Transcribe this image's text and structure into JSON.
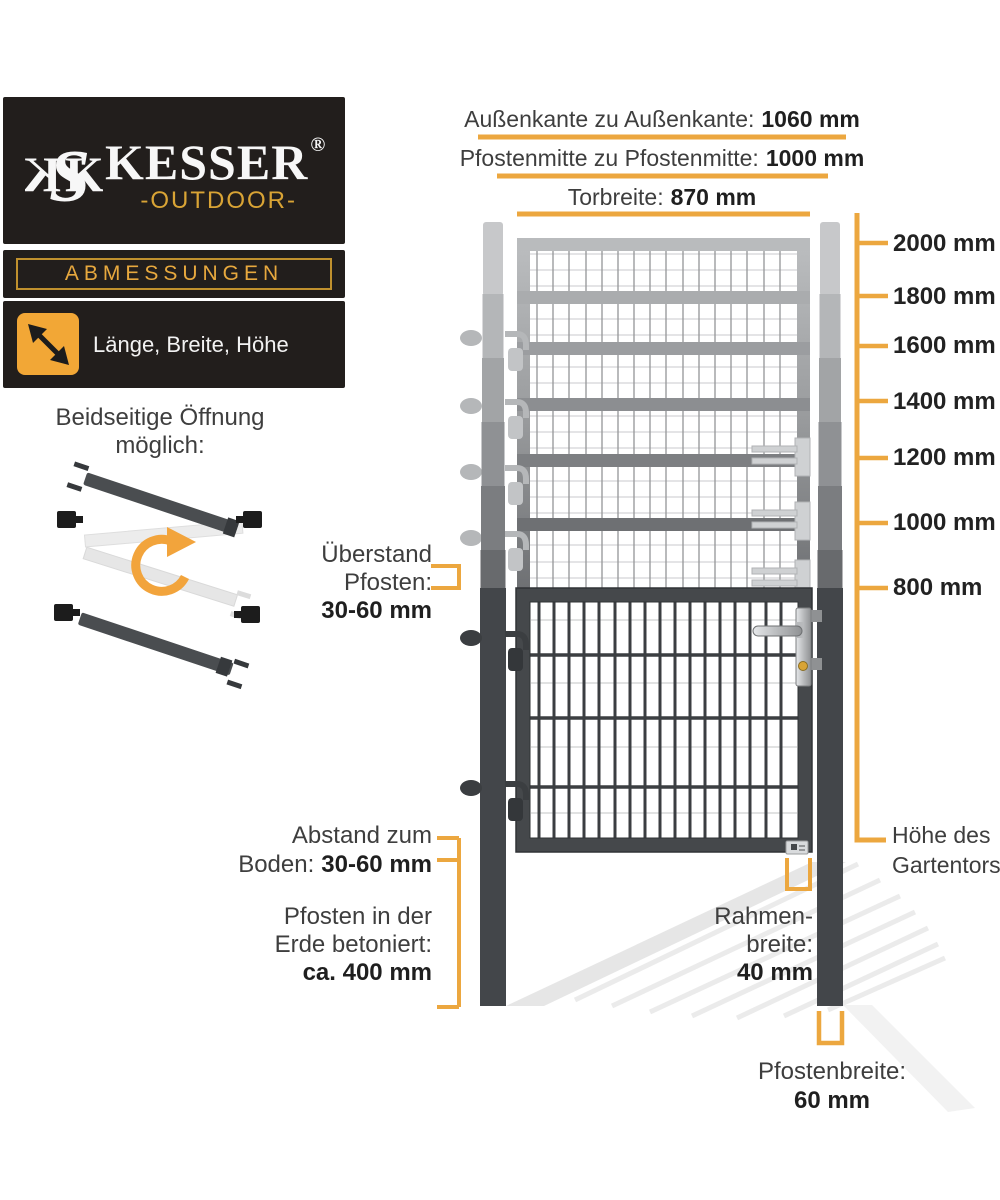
{
  "brand": {
    "monogram_left": "K",
    "monogram_s": "S",
    "monogram_right": "K",
    "name": "KESSER",
    "registered": "®",
    "subtitle": "-OUTDOOR-",
    "section_title": "ABMESSUNGEN",
    "dimensions_caption": "Länge, Breite, Höhe"
  },
  "opening_note": {
    "line1": "Beidseitige Öffnung",
    "line2": "möglich:"
  },
  "top_dimensions": [
    {
      "label": "Außenkante zu Außenkante:",
      "value": "1060 mm"
    },
    {
      "label": "Pfostenmitte zu Pfostenmitte:",
      "value": "1000 mm"
    },
    {
      "label": "Torbreite:",
      "value": "870 mm"
    }
  ],
  "height_scale": {
    "ticks": [
      "2000 mm",
      "1800 mm",
      "1600 mm",
      "1400 mm",
      "1200 mm",
      "1000 mm",
      "800 mm"
    ],
    "axis_label_line1": "Höhe des",
    "axis_label_line2": "Gartentors"
  },
  "callouts": {
    "ueberstand": {
      "line1": "Überstand",
      "line2": "Pfosten:",
      "value": "30-60 mm"
    },
    "abstand": {
      "line1": "Abstand zum",
      "label2": "Boden:",
      "value": "30-60 mm"
    },
    "betoniert": {
      "line1": "Pfosten in der",
      "line2": "Erde betoniert:",
      "value": "ca. 400 mm"
    },
    "rahmenbreite": {
      "line1": "Rahmen-",
      "line2": "breite:",
      "value": "40 mm"
    },
    "pfostenbreite": {
      "label": "Pfostenbreite:",
      "value": "60 mm"
    }
  },
  "colors": {
    "accent": "#ECA73F",
    "panel_bg": "#221E1C",
    "gold_text": "#D9A435",
    "gate_dark": "#45484B",
    "text": "#3E3E3E",
    "text_bold": "#1F1F1F"
  }
}
